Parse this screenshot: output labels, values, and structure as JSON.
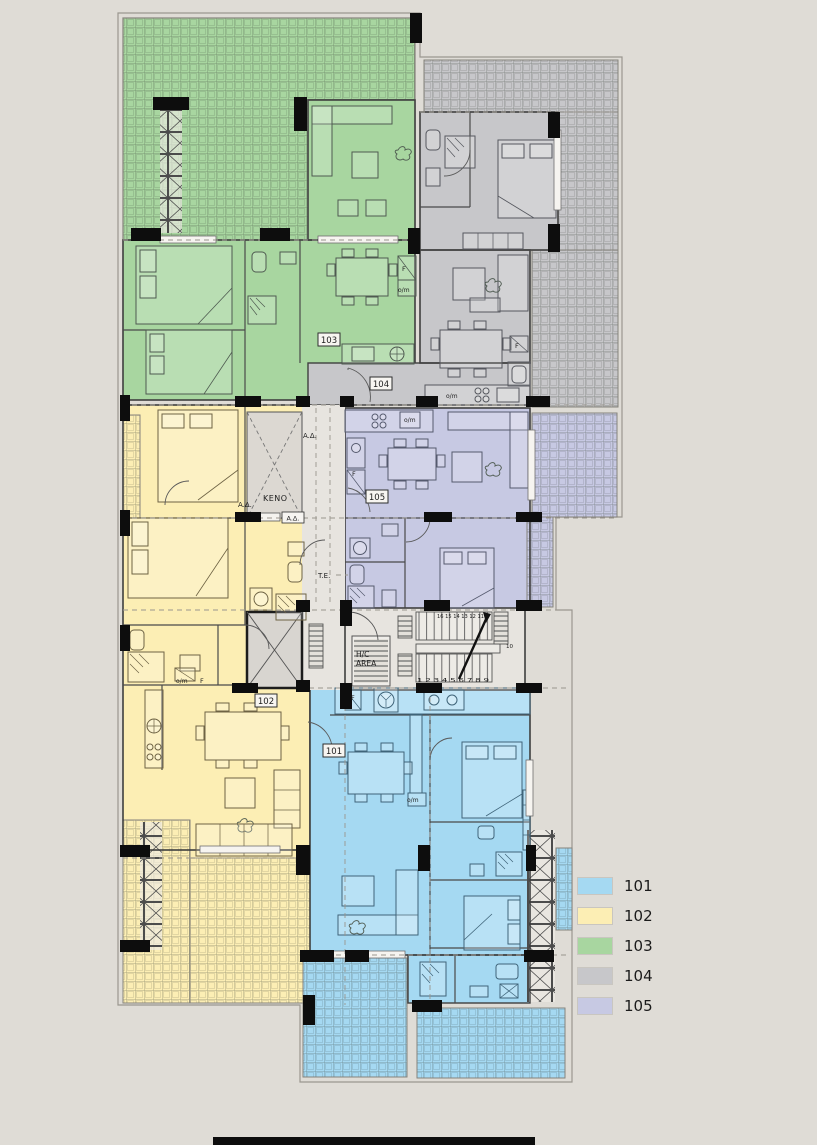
{
  "title": {
    "line1": "1ST",
    "line2": "FLOOR"
  },
  "legend": {
    "items": [
      {
        "id": "101",
        "color": "#a5d9f2"
      },
      {
        "id": "102",
        "color": "#fceeb4"
      },
      {
        "id": "103",
        "color": "#a8d6a0"
      },
      {
        "id": "104",
        "color": "#c7c7ca"
      },
      {
        "id": "105",
        "color": "#c7c9e3"
      }
    ]
  },
  "colors": {
    "background": "#dfdcd6",
    "core": "#e7e4df",
    "shaft": "#d8d5d0",
    "void": "#dcd8d2",
    "wall": "#0d0d0d",
    "blue": "#a5d9f2",
    "yellow": "#fceeb4",
    "green": "#a8d6a0",
    "gray": "#c7c7ca",
    "lavender": "#c7c9e3"
  },
  "plan": {
    "units": {
      "u101": "101",
      "u102": "102",
      "u103": "103",
      "u104": "104",
      "u105": "105"
    },
    "annotations": {
      "keno": "KENO",
      "ad": "A.Δ.",
      "te": "T.E.",
      "hc_line1": "H/C",
      "hc_line2": "AREA",
      "fridge": "F",
      "om": "o/m"
    },
    "stairs": {
      "top_numbers": "16 15 14 13 12 11",
      "bottom_numbers": "1 2 3 4 5 6 7 8 9",
      "mid_number": "10"
    }
  }
}
